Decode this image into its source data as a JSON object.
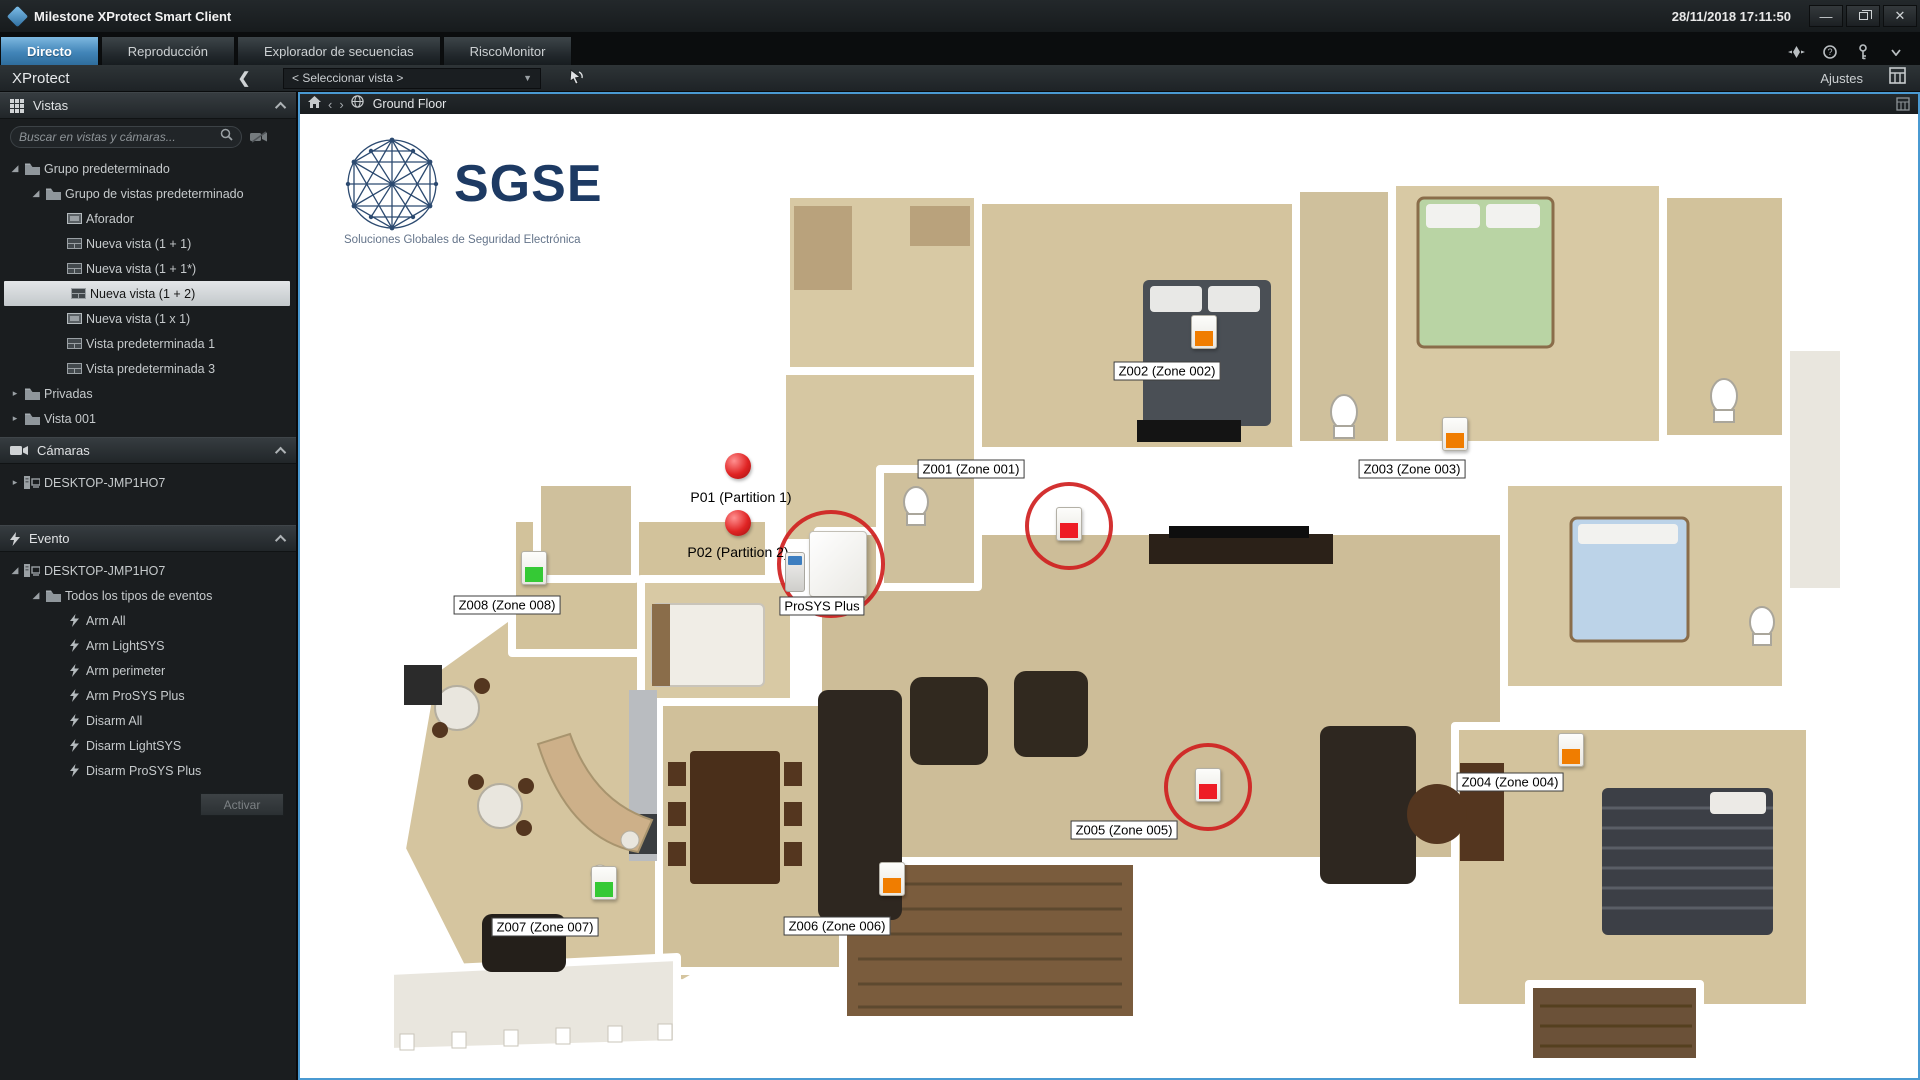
{
  "window": {
    "app_title": "Milestone XProtect Smart Client",
    "datetime": "28/11/2018 17:11:50"
  },
  "tabs": [
    {
      "label": "Directo",
      "active": true
    },
    {
      "label": "Reproducción",
      "active": false
    },
    {
      "label": "Explorador de secuencias",
      "active": false
    },
    {
      "label": "RiscoMonitor",
      "active": false
    }
  ],
  "toolbar": {
    "brand": "XProtect",
    "view_selector": "< Seleccionar vista >",
    "settings_label": "Ajustes"
  },
  "sidebar": {
    "vistas_title": "Vistas",
    "search_placeholder": "Buscar en vistas y cámaras...",
    "vistas_tree": [
      {
        "label": "Grupo predeterminado",
        "level": 0,
        "icon": "folder",
        "expanded": true
      },
      {
        "label": "Grupo de vistas predeterminado",
        "level": 1,
        "icon": "folder",
        "expanded": true
      },
      {
        "label": "Aforador",
        "level": 2,
        "icon": "view1"
      },
      {
        "label": "Nueva vista (1 + 1)",
        "level": 2,
        "icon": "view"
      },
      {
        "label": "Nueva vista (1 + 1*)",
        "level": 2,
        "icon": "view"
      },
      {
        "label": "Nueva vista (1 + 2)",
        "level": 2,
        "icon": "view",
        "selected": true
      },
      {
        "label": "Nueva vista (1 x 1)",
        "level": 2,
        "icon": "view1"
      },
      {
        "label": "Vista predeterminada 1",
        "level": 2,
        "icon": "view"
      },
      {
        "label": "Vista predeterminada 3",
        "level": 2,
        "icon": "view"
      },
      {
        "label": "Privadas",
        "level": 0,
        "icon": "folder",
        "expanded": false
      },
      {
        "label": "Vista 001",
        "level": 0,
        "icon": "folder",
        "expanded": false
      }
    ],
    "camaras_title": "Cámaras",
    "camaras_tree": [
      {
        "label": "DESKTOP-JMP1HO7",
        "level": 0,
        "icon": "server",
        "expanded": false
      }
    ],
    "evento_title": "Evento",
    "evento_tree": [
      {
        "label": "DESKTOP-JMP1HO7",
        "level": 0,
        "icon": "server",
        "expanded": true
      },
      {
        "label": "Todos los tipos de eventos",
        "level": 1,
        "icon": "folder",
        "expanded": true
      },
      {
        "label": "Arm All",
        "level": 2,
        "icon": "bolt"
      },
      {
        "label": "Arm LightSYS",
        "level": 2,
        "icon": "bolt"
      },
      {
        "label": "Arm perimeter",
        "level": 2,
        "icon": "bolt"
      },
      {
        "label": "Arm ProSYS Plus",
        "level": 2,
        "icon": "bolt"
      },
      {
        "label": "Disarm All",
        "level": 2,
        "icon": "bolt"
      },
      {
        "label": "Disarm LightSYS",
        "level": 2,
        "icon": "bolt"
      },
      {
        "label": "Disarm ProSYS Plus",
        "level": 2,
        "icon": "bolt"
      }
    ],
    "activate_button": "Activar"
  },
  "map": {
    "header_title": "Ground Floor",
    "logo_text": "SGSE",
    "logo_tagline": "Soluciones Globales de Seguridad Electrónica",
    "partitions": [
      {
        "id": "P01",
        "label": "P01 (Partition 1)",
        "dot": {
          "x": 438,
          "y": 352
        },
        "label_pos": {
          "x": 441,
          "y": 383
        }
      },
      {
        "id": "P02",
        "label": "P02 (Partition 2)",
        "dot": {
          "x": 438,
          "y": 409
        },
        "label_pos": {
          "x": 438,
          "y": 438
        }
      }
    ],
    "panel_device": {
      "label": "ProSYS Plus",
      "x": 531,
      "y": 450,
      "ring": 108,
      "label_pos": {
        "x": 522,
        "y": 492
      }
    },
    "zones": [
      {
        "id": "Z001",
        "label": "Z001 (Zone 001)",
        "sensor": {
          "x": 769,
          "y": 410
        },
        "label_pos": {
          "x": 671,
          "y": 355
        },
        "color": "#ee1c25",
        "circle": true
      },
      {
        "id": "Z002",
        "label": "Z002 (Zone 002)",
        "sensor": {
          "x": 904,
          "y": 218
        },
        "label_pos": {
          "x": 867,
          "y": 257
        },
        "color": "#f07d00",
        "circle": false
      },
      {
        "id": "Z003",
        "label": "Z003 (Zone 003)",
        "sensor": {
          "x": 1155,
          "y": 320
        },
        "label_pos": {
          "x": 1112,
          "y": 355
        },
        "color": "#f07d00",
        "circle": false
      },
      {
        "id": "Z004",
        "label": "Z004 (Zone 004)",
        "sensor": {
          "x": 1271,
          "y": 636
        },
        "label_pos": {
          "x": 1210,
          "y": 668
        },
        "color": "#f07d00",
        "circle": false
      },
      {
        "id": "Z005",
        "label": "Z005 (Zone 005)",
        "sensor": {
          "x": 908,
          "y": 671
        },
        "label_pos": {
          "x": 824,
          "y": 716
        },
        "color": "#ee1c25",
        "circle": true
      },
      {
        "id": "Z006",
        "label": "Z006 (Zone 006)",
        "sensor": {
          "x": 592,
          "y": 765
        },
        "label_pos": {
          "x": 537,
          "y": 812
        },
        "color": "#f07d00",
        "circle": false
      },
      {
        "id": "Z007",
        "label": "Z007 (Zone 007)",
        "sensor": {
          "x": 304,
          "y": 769
        },
        "label_pos": {
          "x": 245,
          "y": 813
        },
        "color": "#35c935",
        "circle": false
      },
      {
        "id": "Z008",
        "label": "Z008 (Zone 008)",
        "sensor": {
          "x": 234,
          "y": 454
        },
        "label_pos": {
          "x": 207,
          "y": 491
        },
        "color": "#35c935",
        "circle": false
      }
    ]
  },
  "colors": {
    "accent_blue": "#4a9ad2",
    "alarm_red": "#cf1f1f",
    "status_red": "#ee1c25",
    "status_orange": "#f07d00",
    "status_green": "#35c935"
  }
}
